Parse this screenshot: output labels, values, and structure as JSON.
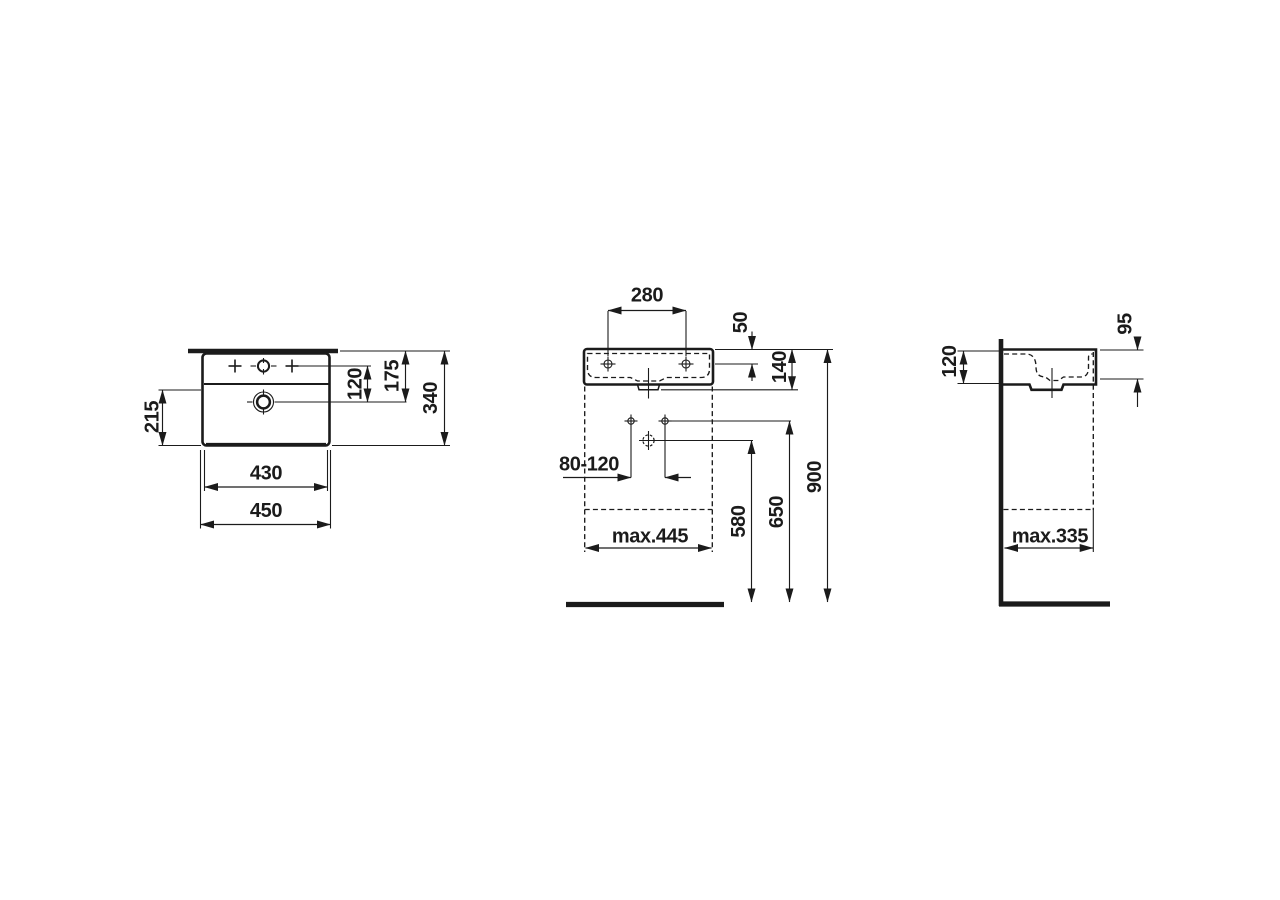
{
  "drawing": {
    "type": "technical-dimension-drawing",
    "subject": "wall-mounted washbasin, three orthographic views",
    "background_color": "#ffffff",
    "line_color": "#1b1b1b"
  },
  "views": {
    "top": {
      "title": "top-view-plan",
      "dims": {
        "bowl_front_depth": "215",
        "tap_to_drain": "120",
        "rim_to_drain": "175",
        "overall_depth": "340",
        "inner_width": "430",
        "overall_width": "450"
      }
    },
    "front": {
      "title": "front-view",
      "dims": {
        "tap_hole_spacing": "280",
        "rim_to_fixing_holes": "50",
        "body_height": "140",
        "supply_spacing": "80-120",
        "drain_outlet_height": "580",
        "supply_height": "650",
        "rim_height": "900",
        "clearance_width": "max.445"
      }
    },
    "side": {
      "title": "side-view",
      "dims": {
        "body_height": "120",
        "inner_depth": "95",
        "clearance_depth": "max.335"
      }
    }
  }
}
